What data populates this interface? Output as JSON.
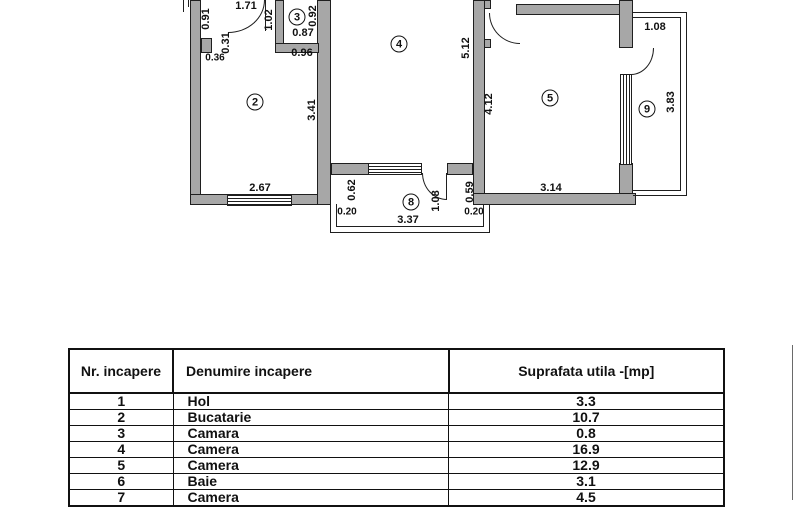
{
  "plan": {
    "rooms": {
      "r2": "2",
      "r3": "3",
      "r4": "4",
      "r5": "5",
      "r8": "8",
      "r9": "9"
    },
    "dims": {
      "v091": "0.91",
      "h171": "1.71",
      "v102": "1.02",
      "v092": "0.92",
      "h087": "0.87",
      "v031": "0.31",
      "h036": "0.36",
      "h096": "0.96",
      "v341": "3.41",
      "h267": "2.67",
      "v512": "5.12",
      "v412": "4.12",
      "h314": "3.14",
      "h108_balcony": "1.08",
      "v383": "3.83",
      "v062": "0.62",
      "h020_left": "0.20",
      "v108_door": "1.08",
      "v059": "0.59",
      "h020_right": "0.20",
      "h337": "3.37"
    }
  },
  "table": {
    "headers": [
      "Nr. incapere",
      "Denumire  incapere",
      "Suprafata utila -[mp]"
    ],
    "rows": [
      [
        "1",
        "Hol",
        "3.3"
      ],
      [
        "2",
        "Bucatarie",
        "10.7"
      ],
      [
        "3",
        "Camara",
        "0.8"
      ],
      [
        "4",
        "Camera",
        "16.9"
      ],
      [
        "5",
        "Camera",
        "12.9"
      ],
      [
        "6",
        "Baie",
        "3.1"
      ],
      [
        "7",
        "Camera",
        "4.5"
      ]
    ]
  },
  "colors": {
    "wall": "#a7a7a7",
    "line": "#1f1f1f",
    "text": "#111111"
  }
}
